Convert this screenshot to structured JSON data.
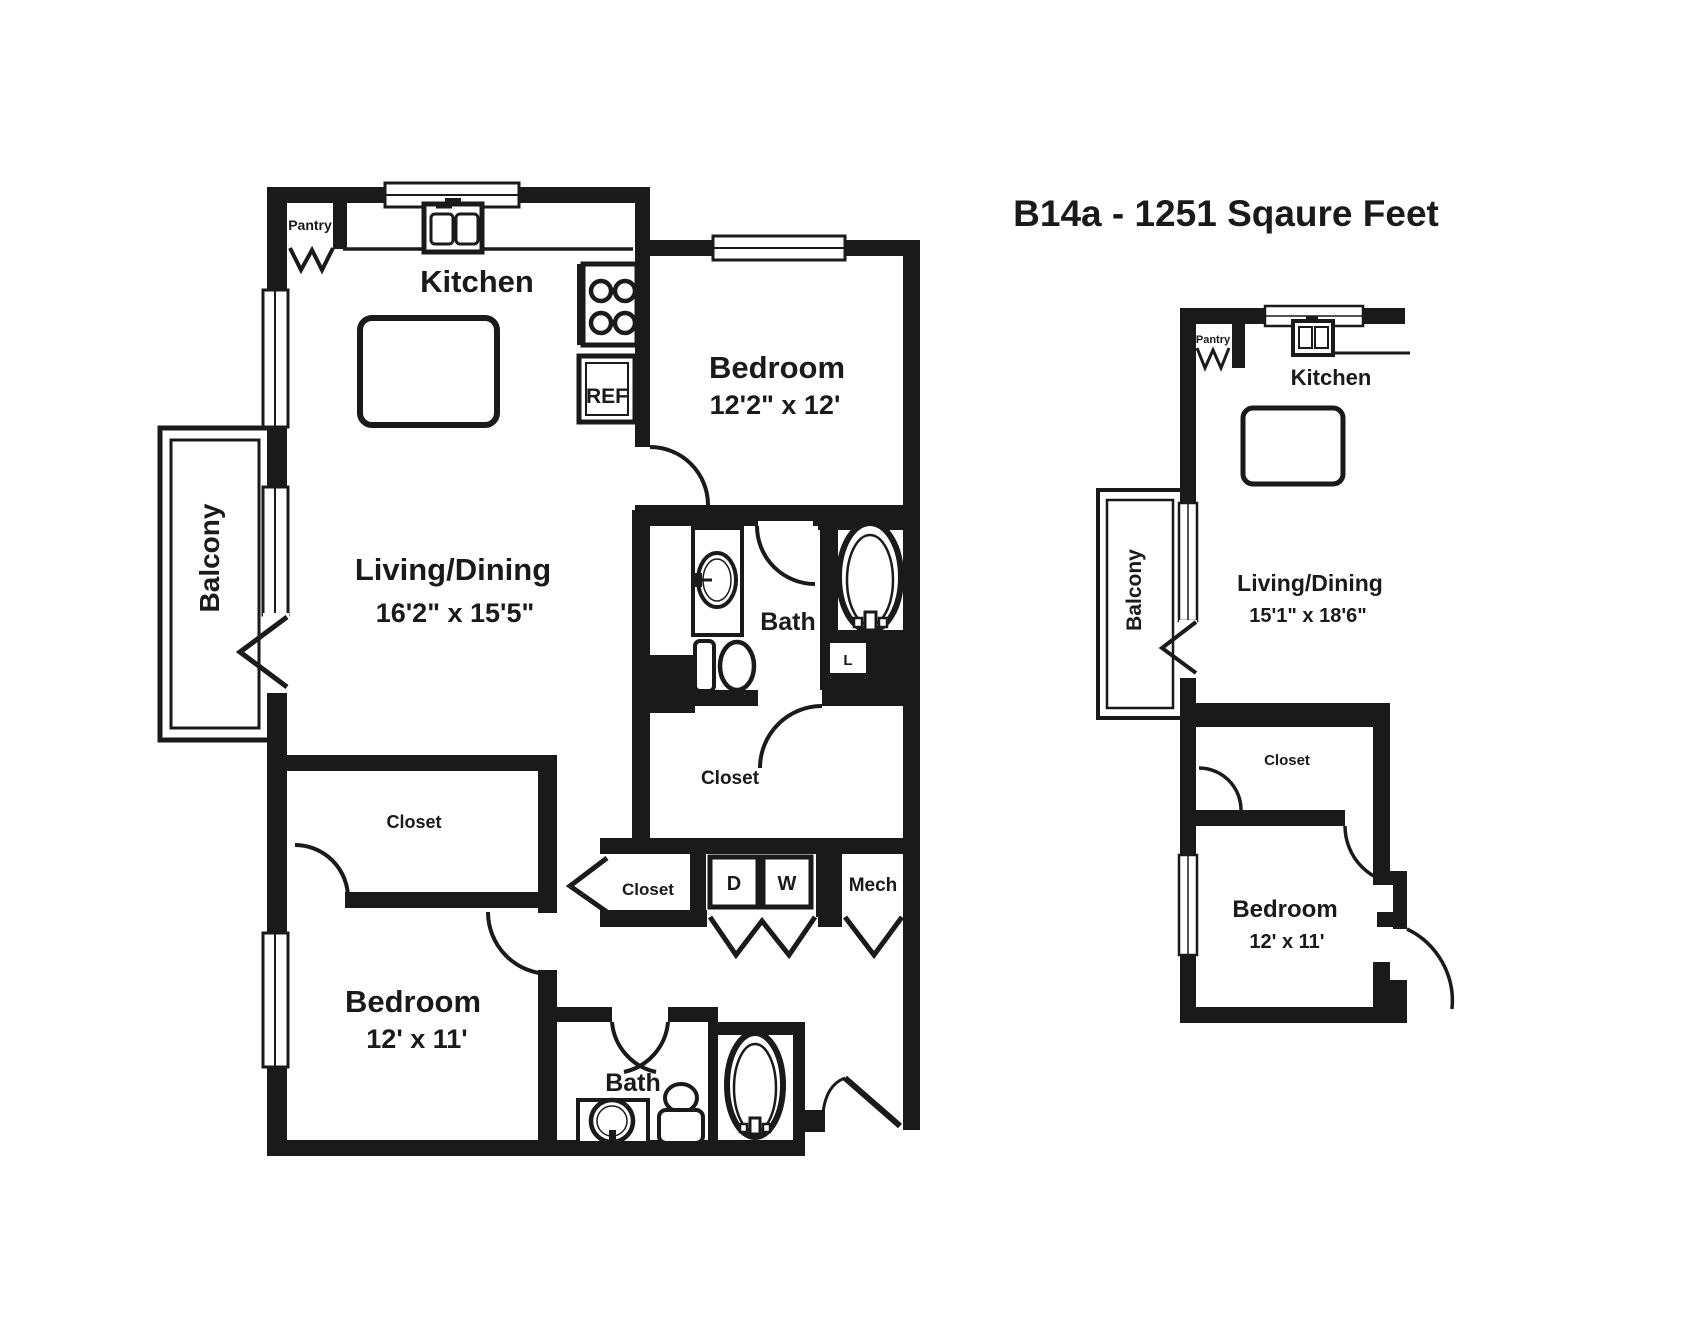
{
  "title": "B14a - 1251 Sqaure Feet",
  "colors": {
    "ink": "#1a1a1a",
    "background": "#ffffff"
  },
  "main_plan": {
    "kitchen_label": "Kitchen",
    "pantry_label": "Pantry",
    "ref_label": "REF",
    "living_label": "Living/Dining",
    "living_dims": "16'2\" x 15'5\"",
    "balcony_label": "Balcony",
    "bedroom1_label": "Bedroom",
    "bedroom1_dims": "12'2\" x 12'",
    "bath1_label": "Bath",
    "linen_label": "L",
    "walkin_closet_label": "Closet",
    "hall_closet_label": "Closet",
    "dryer_label": "D",
    "washer_label": "W",
    "mech_label": "Mech",
    "bedroom2_closet_label": "Closet",
    "bedroom2_label": "Bedroom",
    "bedroom2_dims": "12' x 11'",
    "bath2_label": "Bath"
  },
  "small_plan": {
    "kitchen_label": "Kitchen",
    "pantry_label": "Pantry",
    "living_label": "Living/Dining",
    "living_dims": "15'1\" x 18'6\"",
    "balcony_label": "Balcony",
    "closet_label": "Closet",
    "bedroom_label": "Bedroom",
    "bedroom_dims": "12' x 11'"
  }
}
